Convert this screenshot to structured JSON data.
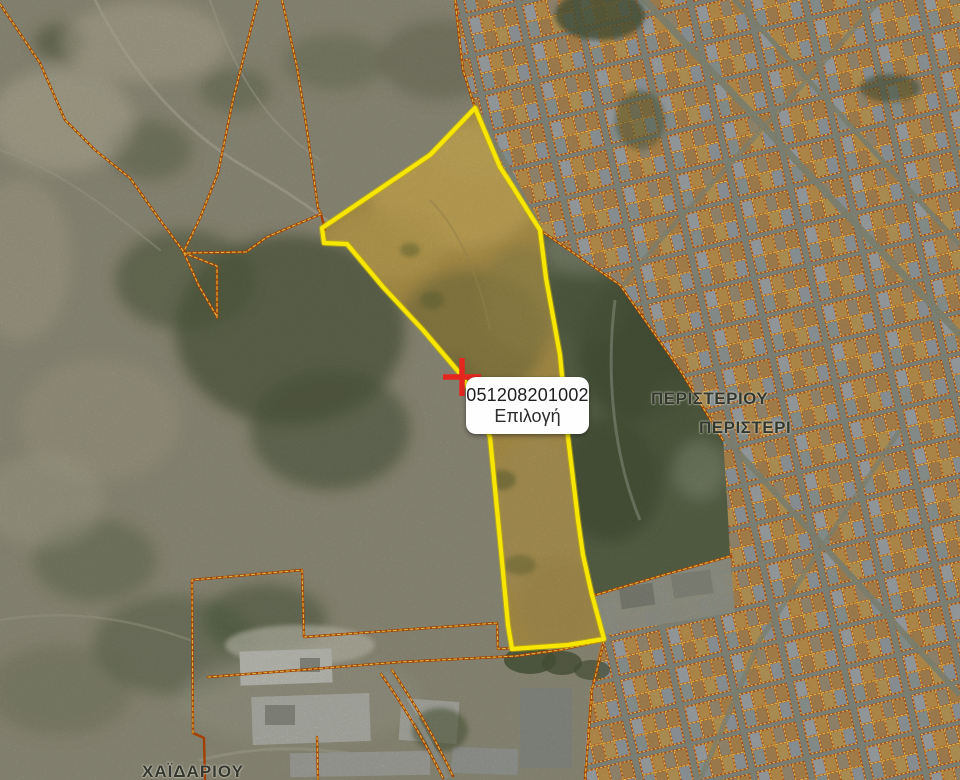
{
  "map": {
    "popup": {
      "parcel_id": "051208201002",
      "action_label": "Επιλογή"
    },
    "place_labels": [
      {
        "id": "peristeriou",
        "text": "ΠΕΡΙΣΤΕΡΙΟΥ"
      },
      {
        "id": "peristeri",
        "text": "ΠΕΡΙΣΤΕΡΙ"
      },
      {
        "id": "chaidariou",
        "text": "ΧΑΪΔΑΡΙΟΥ"
      }
    ],
    "marker": {
      "type": "selection-cross",
      "color": "#e5261f"
    },
    "selected_parcel": {
      "outline_color": "#f7e600"
    },
    "cadastral_line_color": "#bf4a00",
    "cadastral_dash_color": "#ffd84d",
    "city_street_color": "#8e9284"
  }
}
